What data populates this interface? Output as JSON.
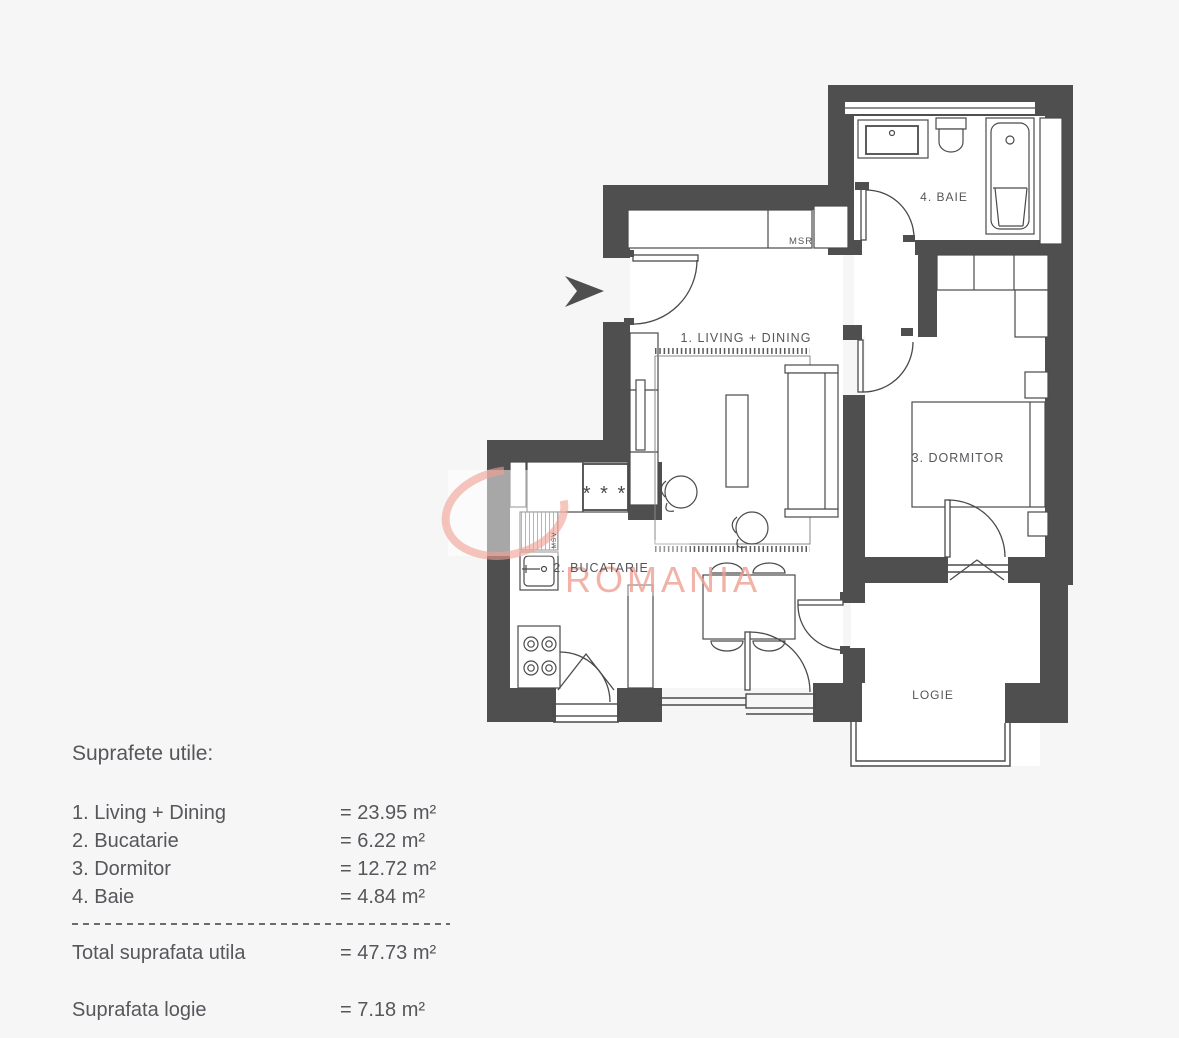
{
  "page": {
    "background": "#f6f6f7"
  },
  "floorplan": {
    "rooms": [
      {
        "id": "living",
        "label": "1. LIVING + DINING"
      },
      {
        "id": "bucatarie",
        "label": "2. BUCATARIE"
      },
      {
        "id": "dormitor",
        "label": "3. DORMITOR"
      },
      {
        "id": "baie",
        "label": "4. BAIE"
      },
      {
        "id": "logie",
        "label": "LOGIE"
      }
    ],
    "annotations": {
      "msr": "MSR",
      "msv": "MSV",
      "freezer": "* * *"
    },
    "colors": {
      "wall": "#4f4f4f",
      "line": "#4a4a4a",
      "room": "#ffffff",
      "watermark": "#f0a093",
      "text": "#55565a"
    }
  },
  "watermark": {
    "text": "ROMANIA"
  },
  "legend": {
    "title": "Suprafete utile:",
    "items": [
      {
        "label": "1. Living + Dining",
        "value": "= 23.95 m²"
      },
      {
        "label": "2. Bucatarie",
        "value": "= 6.22 m²"
      },
      {
        "label": "3. Dormitor",
        "value": "= 12.72 m²"
      },
      {
        "label": "4. Baie",
        "value": "= 4.84 m²"
      }
    ],
    "total": {
      "label": "Total suprafata utila",
      "value": "= 47.73 m²"
    },
    "logie": {
      "label": "Suprafata logie",
      "value": "= 7.18 m²"
    }
  }
}
